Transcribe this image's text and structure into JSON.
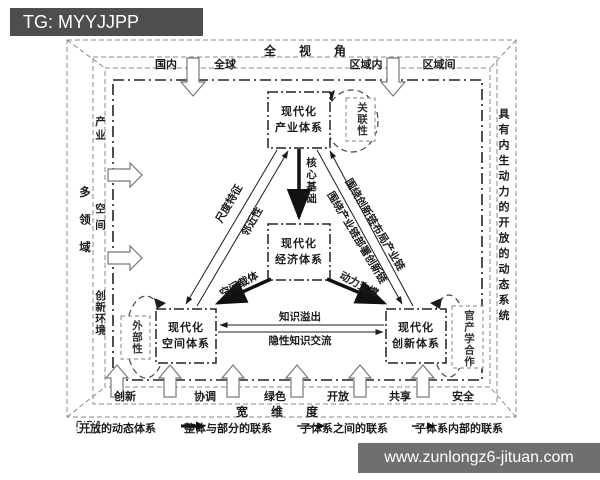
{
  "watermarks": {
    "tag": "TG: MYYJJPP",
    "url": "www.zunlongz6-jituan.com"
  },
  "frame": {
    "perspective_label": "全 视 角",
    "scope_labels": [
      "国内",
      "全球",
      "区域内",
      "区域间"
    ],
    "domain_label": "多领域",
    "domain_items": [
      "产业",
      "空间",
      "创新环境"
    ],
    "dimension_label": "宽 维 度",
    "dimension_items": [
      "创新",
      "协调",
      "绿色",
      "开放",
      "共享",
      "安全"
    ],
    "system_label": "具有内生动力的开放的动态系统"
  },
  "nodes": {
    "industry": {
      "line1": "现代化",
      "line2": "产业体系"
    },
    "economy": {
      "line1": "现代化",
      "line2": "经济体系"
    },
    "space": {
      "line1": "现代化",
      "line2": "空间体系"
    },
    "innovation": {
      "line1": "现代化",
      "line2": "创新体系"
    },
    "relevance": "关联性",
    "externality": "外部性",
    "industry_academia": "官产学合作"
  },
  "edges": {
    "core_foundation": "核心基础",
    "scale_feature": "尺度特征",
    "proximity": "邻近性",
    "chain_layout": "围绕创新链布局产业链",
    "chain_deploy": "围绕产业链部署创新链",
    "spatial_carrier": "空间载体",
    "power_support": "动力支撑",
    "knowledge_spillover": "知识溢出",
    "tacit_exchange": "隐性知识交流"
  },
  "legend": [
    {
      "icon": "dashdot-box-icon",
      "label": "开放的动态体系"
    },
    {
      "icon": "thick-arrow-icon",
      "label": "整体与部分的联系"
    },
    {
      "icon": "thin-arrow-icon",
      "label": "子体系之间的联系"
    },
    {
      "icon": "dash-arrow-icon",
      "label": "子体系内部的联系"
    }
  ],
  "colors": {
    "frame_line": "#8a8a8a",
    "system_line": "#222222",
    "tag_bg": "#4e4e50",
    "url_bg": "#6f6f6f"
  }
}
